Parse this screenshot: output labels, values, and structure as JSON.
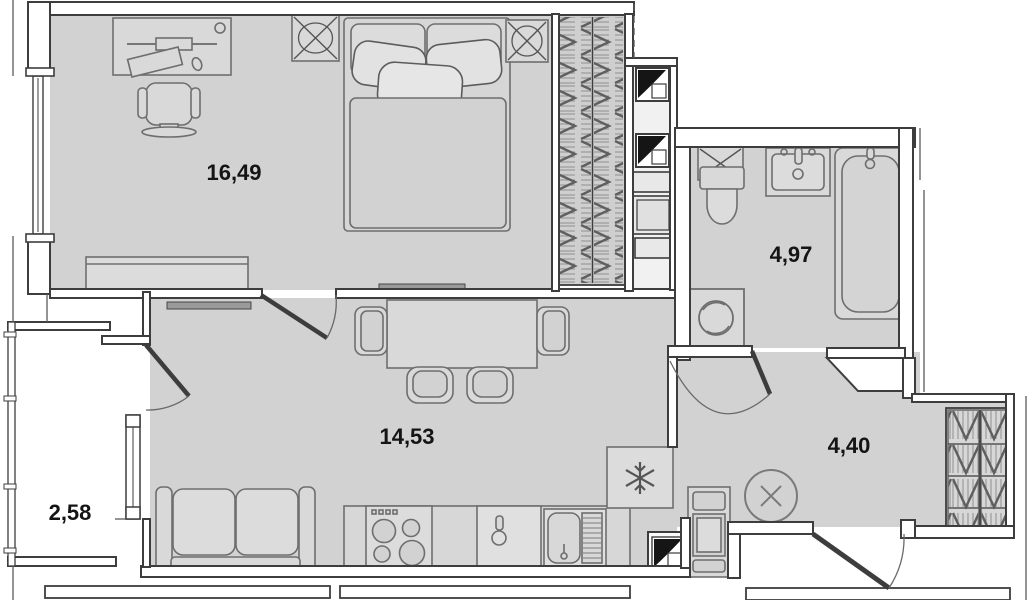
{
  "document": {
    "type": "apartment-floor-plan"
  },
  "rooms": [
    {
      "id": "bedroom",
      "area_label": "16,49"
    },
    {
      "id": "living-kitchen",
      "area_label": "14,53"
    },
    {
      "id": "bathroom",
      "area_label": "4,97"
    },
    {
      "id": "hallway",
      "area_label": "4,40"
    },
    {
      "id": "balcony",
      "area_label": "2,58"
    }
  ],
  "icons": {
    "wardrobe_x_box": "crossed-square",
    "vent_grille": "crossed-square",
    "duct_flag": "black-corner-triangle",
    "fridge": "snowflake",
    "ceiling_light": "circle-x",
    "washing_machine": "drum-circle"
  },
  "colors": {
    "background": "#ffffff",
    "floor": "#d2d2d2",
    "shaft_floor": "#f1f1f1",
    "wall_stroke": "#3d3d3d",
    "furniture_stroke": "#6e6e6e",
    "label": "#141414"
  }
}
